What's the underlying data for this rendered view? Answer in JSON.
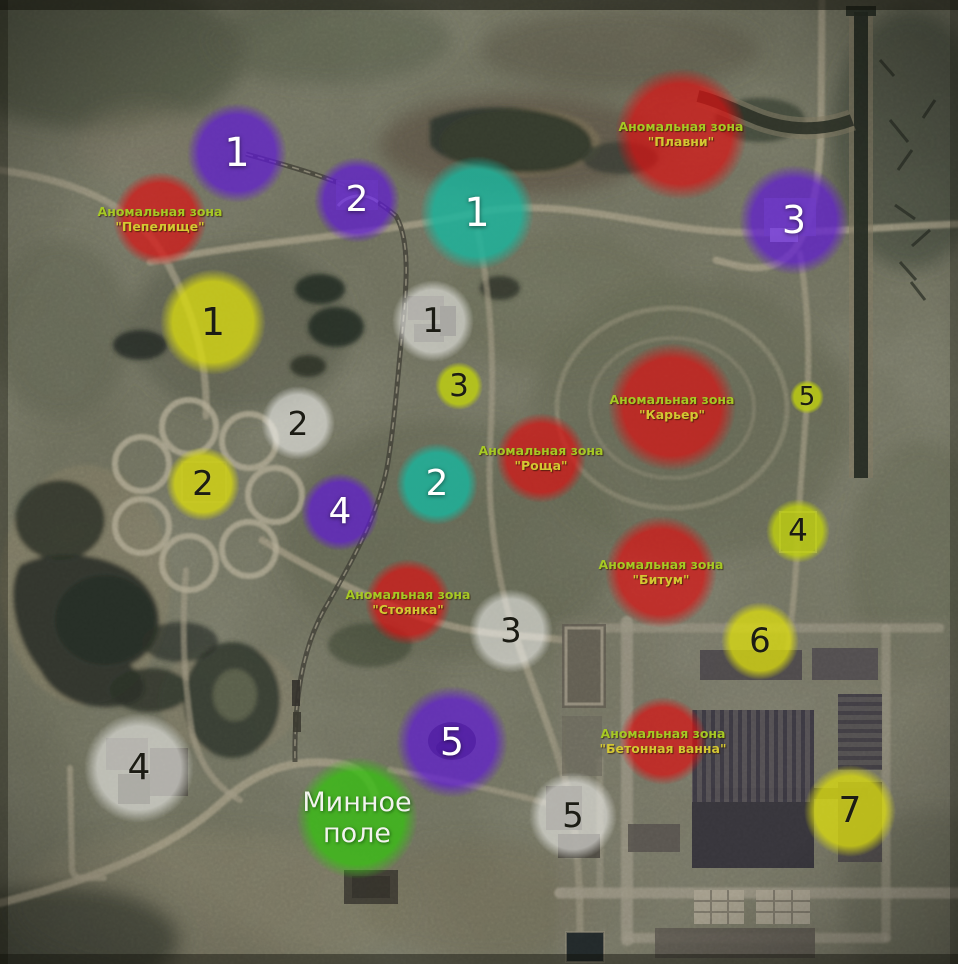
{
  "colors": {
    "zone_fill": "rgba(216,19,19,0.72)",
    "zone_label_line1": "#a6c924",
    "zone_label_line2": "#d4c832",
    "minefield_fill": "rgba(57,190,20,0.80)",
    "minefield_text": "#f2f3ee",
    "series": {
      "purple": "rgba(95,24,214,0.70)",
      "teal": "rgba(26,181,157,0.82)",
      "yellow": "rgba(218,219,16,0.78)",
      "lime": "rgba(193,210,13,0.80)",
      "white": "rgba(248,248,246,0.56)"
    }
  },
  "anomaly_zones": [
    {
      "name_line1": "Аномальная зона",
      "name_line2": "\"Пепелище\"",
      "x": 160,
      "y": 219,
      "r": 47
    },
    {
      "name_line1": "Аномальная зона",
      "name_line2": "\"Плавни\"",
      "x": 681,
      "y": 134,
      "r": 66
    },
    {
      "name_line1": "Аномальная зона",
      "name_line2": "\"Карьер\"",
      "x": 672,
      "y": 407,
      "r": 64
    },
    {
      "name_line1": "Аномальная зона",
      "name_line2": "\"Роща\"",
      "x": 541,
      "y": 458,
      "r": 45
    },
    {
      "name_line1": "Аномальная зона",
      "name_line2": "\"Битум\"",
      "x": 661,
      "y": 572,
      "r": 56
    },
    {
      "name_line1": "Аномальная зона",
      "name_line2": "\"Стоянка\"",
      "x": 408,
      "y": 602,
      "r": 43
    },
    {
      "name_line1": "Аномальная зона",
      "name_line2": "\"Бетонная ванна\"",
      "x": 663,
      "y": 741,
      "r": 44
    }
  ],
  "marker_series": [
    {
      "series": "purple",
      "number_color": "light",
      "markers": [
        {
          "label": "1",
          "x": 237,
          "y": 153,
          "r": 50,
          "fs": 40
        },
        {
          "label": "2",
          "x": 357,
          "y": 200,
          "r": 43,
          "fs": 36
        },
        {
          "label": "3",
          "x": 794,
          "y": 220,
          "r": 55,
          "fs": 38
        },
        {
          "label": "4",
          "x": 340,
          "y": 512,
          "r": 39,
          "fs": 36
        },
        {
          "label": "5",
          "x": 452,
          "y": 742,
          "r": 56,
          "fs": 38
        }
      ]
    },
    {
      "series": "teal",
      "number_color": "light",
      "markers": [
        {
          "label": "1",
          "x": 477,
          "y": 213,
          "r": 57,
          "fs": 40
        },
        {
          "label": "2",
          "x": 437,
          "y": 484,
          "r": 41,
          "fs": 36
        }
      ]
    },
    {
      "series": "yellow",
      "number_color": "dark",
      "markers": [
        {
          "label": "1",
          "x": 213,
          "y": 322,
          "r": 53,
          "fs": 38
        },
        {
          "label": "2",
          "x": 203,
          "y": 484,
          "r": 37,
          "fs": 34
        },
        {
          "label": "3",
          "x": 459,
          "y": 386,
          "r": 24,
          "fs": 31,
          "fill_series": "lime"
        },
        {
          "label": "4",
          "x": 798,
          "y": 531,
          "r": 32,
          "fs": 31,
          "fill_series": "lime"
        },
        {
          "label": "5",
          "x": 807,
          "y": 397,
          "r": 17,
          "fs": 26,
          "fill_series": "lime"
        },
        {
          "label": "6",
          "x": 760,
          "y": 641,
          "r": 39,
          "fs": 34
        },
        {
          "label": "7",
          "x": 850,
          "y": 811,
          "r": 46,
          "fs": 36
        }
      ]
    },
    {
      "series": "white",
      "number_color": "dark",
      "markers": [
        {
          "label": "1",
          "x": 433,
          "y": 321,
          "r": 41,
          "fs": 34
        },
        {
          "label": "2",
          "x": 298,
          "y": 423,
          "r": 37,
          "fs": 33
        },
        {
          "label": "3",
          "x": 511,
          "y": 631,
          "r": 42,
          "fs": 34
        },
        {
          "label": "4",
          "x": 139,
          "y": 768,
          "r": 55,
          "fs": 36
        },
        {
          "label": "5",
          "x": 573,
          "y": 816,
          "r": 44,
          "fs": 34
        }
      ]
    }
  ],
  "minefield": {
    "line1": "Минное",
    "line2": "поле",
    "x": 357,
    "y": 818,
    "r": 61,
    "fs": 27
  }
}
